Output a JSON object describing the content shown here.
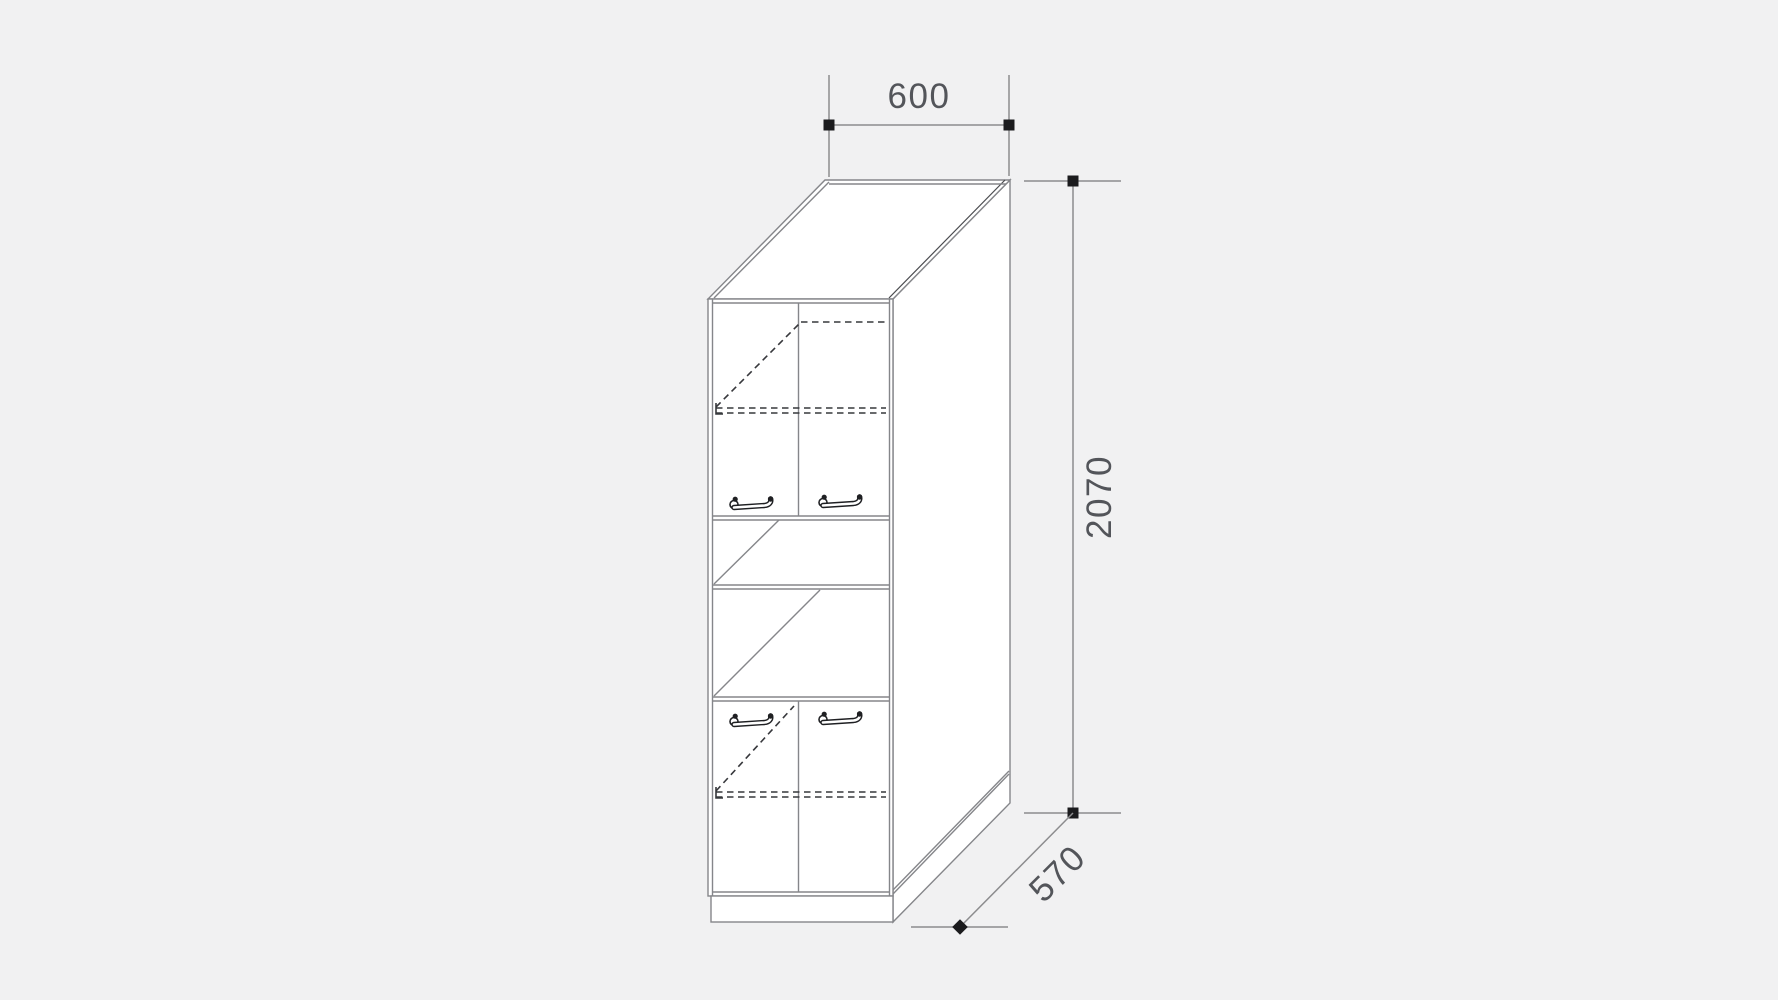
{
  "drawing": {
    "subject": "tall-kitchen-cabinet-technical-drawing",
    "dimensions": {
      "width_mm": "600",
      "height_mm": "2070",
      "depth_mm": "570"
    },
    "features": {
      "upper_doors": 2,
      "lower_doors": 2,
      "open_niches": 2,
      "handles": 4,
      "dashed_shelves": 2
    },
    "colors": {
      "background": "#f1f1f2",
      "surface": "#ffffff",
      "line": "#85868a",
      "line_dark": "#37383c",
      "marker": "#1b1b1d",
      "text": "#53555a"
    }
  }
}
